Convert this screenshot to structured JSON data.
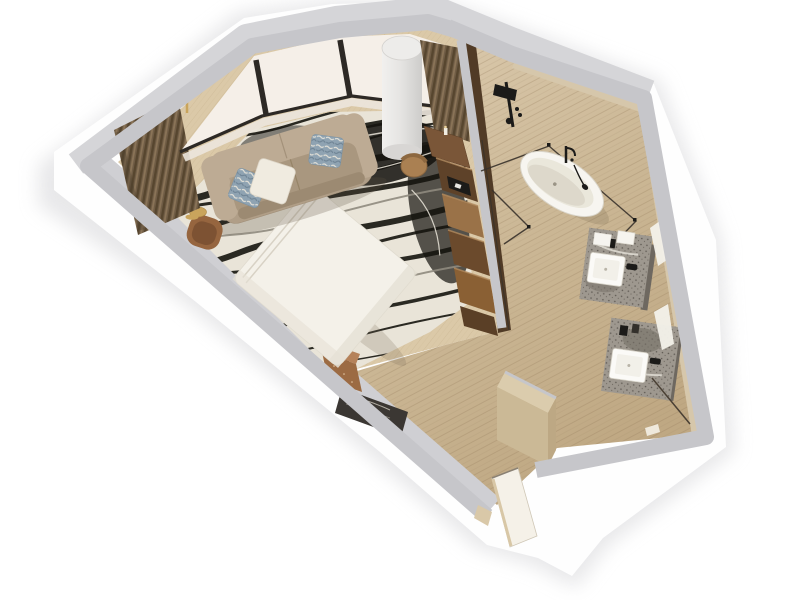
{
  "scene": {
    "type": "axonometric-3d-floor-plan-render",
    "setting": "hotel-suite-with-open-bathroom",
    "background": "#ffffff",
    "rooms": [
      "bedroom-living-area",
      "bathroom",
      "entry-corridor"
    ]
  },
  "palette": {
    "background": "#ffffff",
    "skirt": "#fefefe",
    "shadow": "#d9d9dc",
    "wallTop": "#c6c6ca",
    "wallOuterTop": "#d5d5d8",
    "wallInnerFace": "#cfcfd3",
    "wallStone": "#d6c7ab",
    "carpet": "#dbc9a8",
    "rugBase": "#e9e4d8",
    "rugVein": "#16140f",
    "travertineLight": "#ddccb0",
    "travertineDark": "#bfa883",
    "sofa": "#b09e87",
    "sofaBack": "#bdab94",
    "sofaSeat": "#a9977f",
    "pillowWhite": "#f0ebe0",
    "pillowBlue": "#8fa3b2",
    "bed": "#f4f1e9",
    "drapeDark": "#57462f",
    "drapeMid": "#6f5c45",
    "drapeLight": "#8a7458",
    "sheer": "#f5efe8",
    "windowFrame": "#2d2925",
    "column": "#e9e8e6",
    "woodDesk": "#7a5638",
    "woodDark": "#5e4229",
    "woodMid": "#9a7248",
    "woodDeep": "#6b4a2c",
    "woodWarm": "#8a6034",
    "woodEdge": "#5a3f26",
    "copper": "#9c6b43",
    "copperTop": "#b5825a",
    "darkMarble": "#3b3733",
    "gold": "#c9a45c",
    "goldLight": "#ecd49b",
    "tub": "#f7f5f0",
    "tubInner": "#eae7db",
    "tubShadow": "#d8d3c5",
    "fixtureBlack": "#1c1b19",
    "glass": "#38322b",
    "counterMarble": "#9e988f",
    "counterDark": "#6e6860",
    "sink": "#fbfaf7",
    "towel": "#f6f4ef",
    "mirror": "#f3f1ea",
    "doorLeaf": "#f5f1e8",
    "entryBlock": "#cbb996"
  },
  "objects": [
    {
      "name": "window-bay",
      "detail": "faceted bay with white sheer shades and dark mullions"
    },
    {
      "name": "blackout-curtains",
      "detail": "brown pleated drapes at both ends of bay"
    },
    {
      "name": "sofa",
      "detail": "taupe three-seat sofa with white and blue accent pillows"
    },
    {
      "name": "area-rug",
      "detail": "cream rug with black marble-vein pattern"
    },
    {
      "name": "bed",
      "detail": "white duvet, placed diagonally against lower wall"
    },
    {
      "name": "copper-nightstand",
      "detail": "sparkling copper cube at bed corner"
    },
    {
      "name": "stone-bench",
      "detail": "dark marble bench along lower wall"
    },
    {
      "name": "console-stack",
      "detail": "mixed-tone wood media console along partition with TV"
    },
    {
      "name": "desk-and-chair",
      "detail": "wood desk with tan chair and candle"
    },
    {
      "name": "column",
      "detail": "white structural cylinder at window"
    },
    {
      "name": "floor-lamp",
      "detail": "gold arc floor lamp"
    },
    {
      "name": "side-table",
      "detail": "small gold drum table"
    },
    {
      "name": "armchair",
      "detail": "rust leather lounge chair"
    },
    {
      "name": "bathtub",
      "detail": "freestanding white oval tub with black floor faucet"
    },
    {
      "name": "shower",
      "detail": "black exposed rain-shower set on stone wall"
    },
    {
      "name": "glass-enclosure",
      "detail": "frameless glass panels around wet zone"
    },
    {
      "name": "vanity-1",
      "detail": "grey marble counter, vessel sink, black faucet, towels"
    },
    {
      "name": "vanity-2",
      "detail": "grey marble counter, vessel sink, black faucet, amenities"
    },
    {
      "name": "mirrors",
      "detail": "bright reflection slivers on stone wall"
    },
    {
      "name": "wc-door",
      "detail": "open door line at lower right"
    },
    {
      "name": "entry-door",
      "detail": "open door leaf at bottom vertex"
    },
    {
      "name": "entry-block",
      "detail": "stone-clad wardrobe volume at corridor"
    },
    {
      "name": "floors",
      "detail": "travertine stone in bath/corridor, beige carpet in bedroom"
    }
  ]
}
